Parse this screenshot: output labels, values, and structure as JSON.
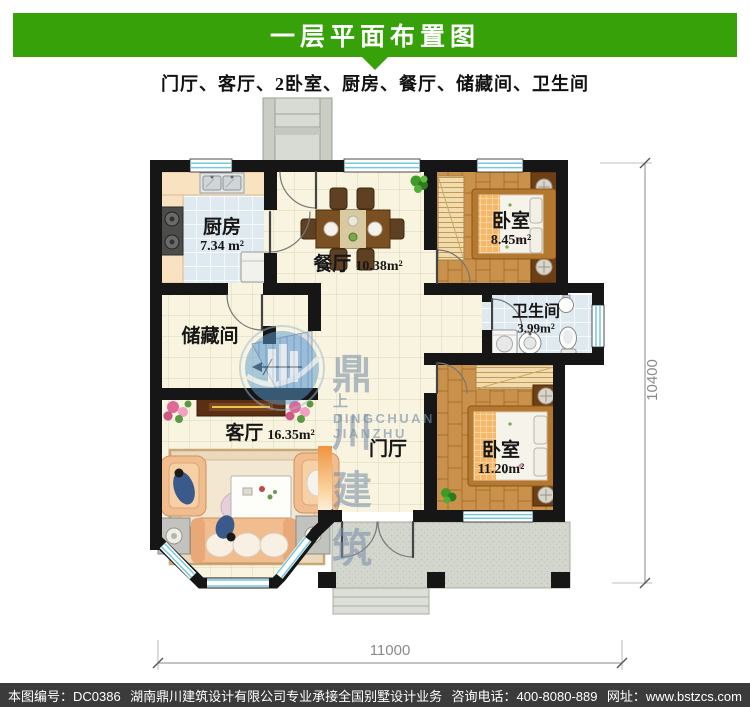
{
  "header": {
    "title": "一层平面布置图",
    "subtitle": "门厅、客厅、2卧室、厨房、餐厅、储藏间、卫生间"
  },
  "colors": {
    "banner_green": "#36a108",
    "wall_black": "#161616",
    "floor_cream": "#f8f4e0",
    "floor_wood": "#c9914b",
    "tile_blue": "#dfe9f0",
    "window_cyan": "#76c8de",
    "accent_orange": "#f09a45",
    "footer_bg": "#3b3b3b"
  },
  "rooms": {
    "kitchen": {
      "name": "厨房",
      "area": "7.34 m²"
    },
    "dining": {
      "name": "餐厅",
      "area": "10.38m²"
    },
    "bedroom_top": {
      "name": "卧室",
      "area": "8.45m²"
    },
    "bathroom": {
      "name": "卫生间",
      "area": "3.99m²"
    },
    "storage": {
      "name": "储藏间"
    },
    "living": {
      "name": "客厅",
      "area": "16.35m²"
    },
    "foyer": {
      "name": "门厅"
    },
    "bedroom_bottom": {
      "name": "卧室",
      "area": "11.20m²"
    }
  },
  "dimensions": {
    "bottom": "11000",
    "right": "10400"
  },
  "watermark": {
    "prefix": "上",
    "name": "鼎川建筑",
    "latin": "DINGCHUAN JIANZHU"
  },
  "footer": {
    "serial": "本图编号：DC0386",
    "company": "湖南鼎川建筑设计有限公司专业承接全国别墅设计业务",
    "phone": "咨询电话：400-8080-889",
    "website": "网址：www.bstzcs.com"
  }
}
